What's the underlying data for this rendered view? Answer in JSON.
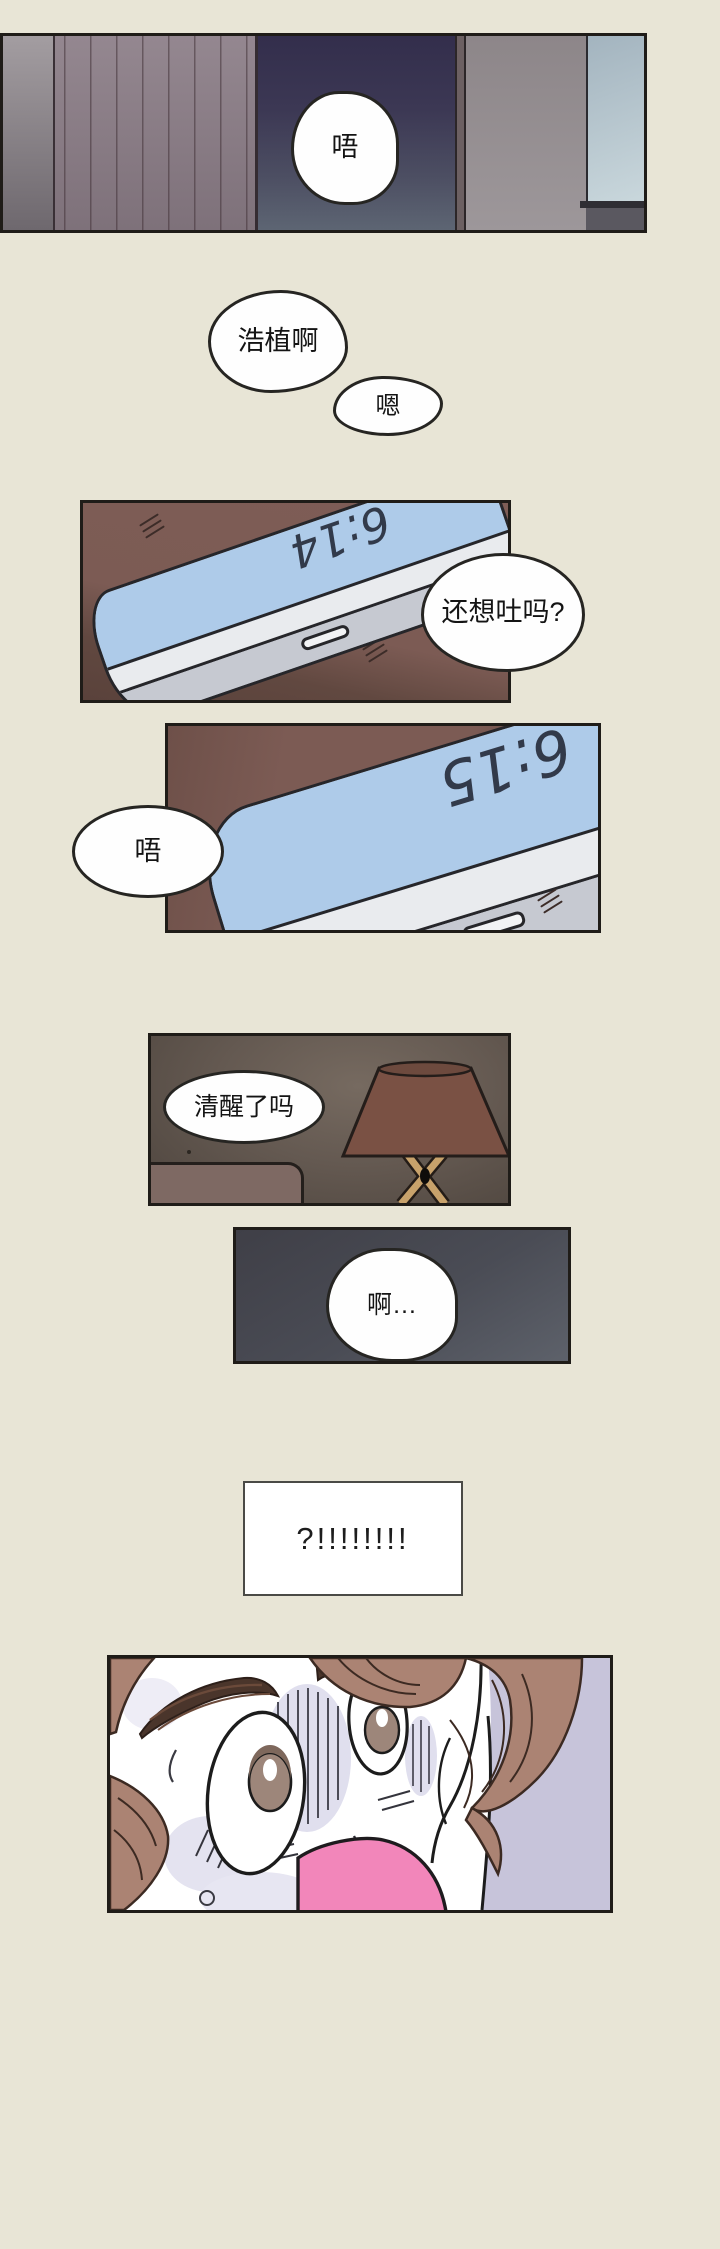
{
  "comic": {
    "panel_bedroom": {
      "bubble_groan": "唔"
    },
    "float_bubbles": {
      "call_name": "浩植啊",
      "reply_mm": "嗯"
    },
    "panel_phone_first": {
      "time": "6:14",
      "bubble_question": "还想吐吗?"
    },
    "panel_phone_second": {
      "time": "6:15",
      "bubble_groan": "唔"
    },
    "panel_lamp": {
      "bubble_question": "清醒了吗"
    },
    "panel_dark_reply": {
      "bubble_reply": "啊…"
    },
    "shock_box": {
      "text": "?!!!!!!!!"
    },
    "palette": {
      "page_background": "#e8e5d6",
      "table_brown": "#7c5b54",
      "phone_screen_blue": "#aecbe9",
      "doorway_navy": "#37324e",
      "lamp_shade_brown": "#7a5144",
      "face_background_lavender": "#c7c4da",
      "hair_brown": "#ab8373",
      "mouth_pink": "#f286ba"
    }
  }
}
